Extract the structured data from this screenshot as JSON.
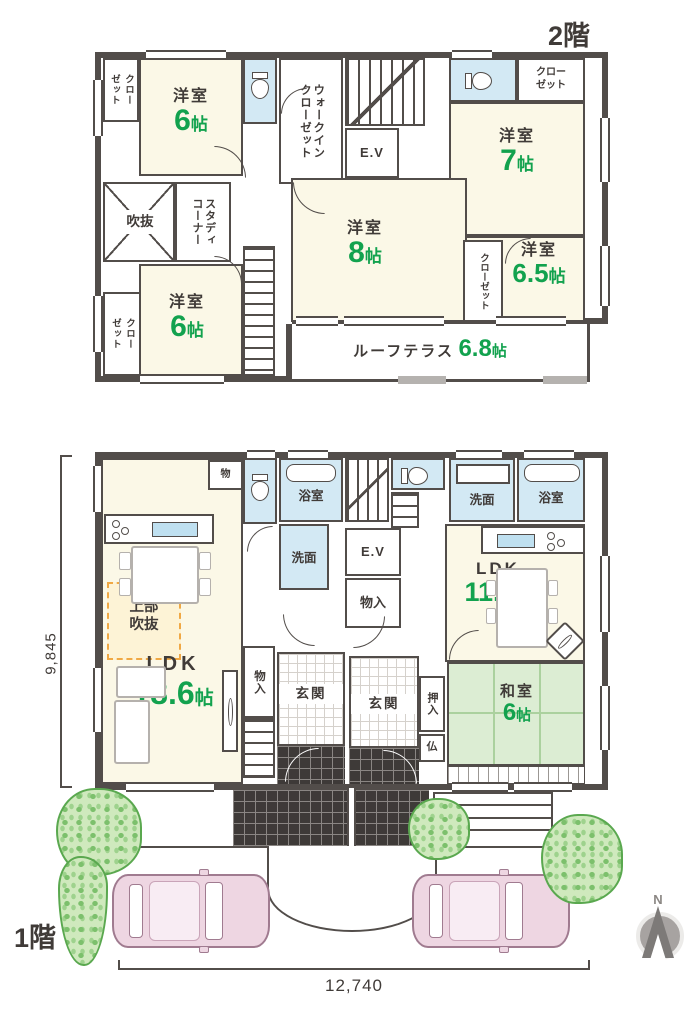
{
  "palette": {
    "wall": "#524d4a",
    "text": "#403b38",
    "accent_green": "#12a24e",
    "room_cream": "#fbf8e7",
    "water_blue": "#d3e9f4",
    "tatami_green": "#dcedd3",
    "void_dash_orange": "#f0a844"
  },
  "floor2": {
    "title": "2階",
    "closet_tl": "クロー\nゼット",
    "room_tl": {
      "name": "洋室",
      "num": "6",
      "unit": "帖"
    },
    "wic": "ウォークイン\nクローゼット",
    "ev": "E.V",
    "closet_tr": "クロー\nゼット",
    "room_tr": {
      "name": "洋室",
      "num": "7",
      "unit": "帖"
    },
    "fukinuke": "吹抜",
    "study": "スタディ\nコーナー",
    "room_c": {
      "name": "洋室",
      "num": "8",
      "unit": "帖"
    },
    "closet_mid": "クローゼット",
    "room_r": {
      "name": "洋室",
      "num": "6.5",
      "unit": "帖"
    },
    "room_bl": {
      "name": "洋室",
      "num": "6",
      "unit": "帖"
    },
    "closet_bl": "クロー\nゼット",
    "terrace": {
      "name": "ルーフテラス",
      "num": "6.8",
      "unit": "帖"
    }
  },
  "floor1": {
    "title": "1階",
    "closet_top": "物",
    "bath_l": "浴室",
    "wash_l": "洗面",
    "ev": "E.V",
    "closet_c": "物入",
    "wash_r": "洗面",
    "bath_r": "浴室",
    "ldk_r": {
      "name": "LDK",
      "num": "11.3",
      "unit": "帖"
    },
    "void_above": "上部\n吹抜",
    "ldk_l": {
      "name": "LDK",
      "num": "18.6",
      "unit": "帖"
    },
    "closet_b": "物入",
    "genkan_l": "玄関",
    "genkan_r": "玄関",
    "oshiire": "押入",
    "butsudan": "仏",
    "washitsu": {
      "name": "和室",
      "num": "6",
      "unit": "帖"
    }
  },
  "dimensions": {
    "width": "12,740",
    "depth": "9,845"
  },
  "compass": {
    "north": "N"
  }
}
